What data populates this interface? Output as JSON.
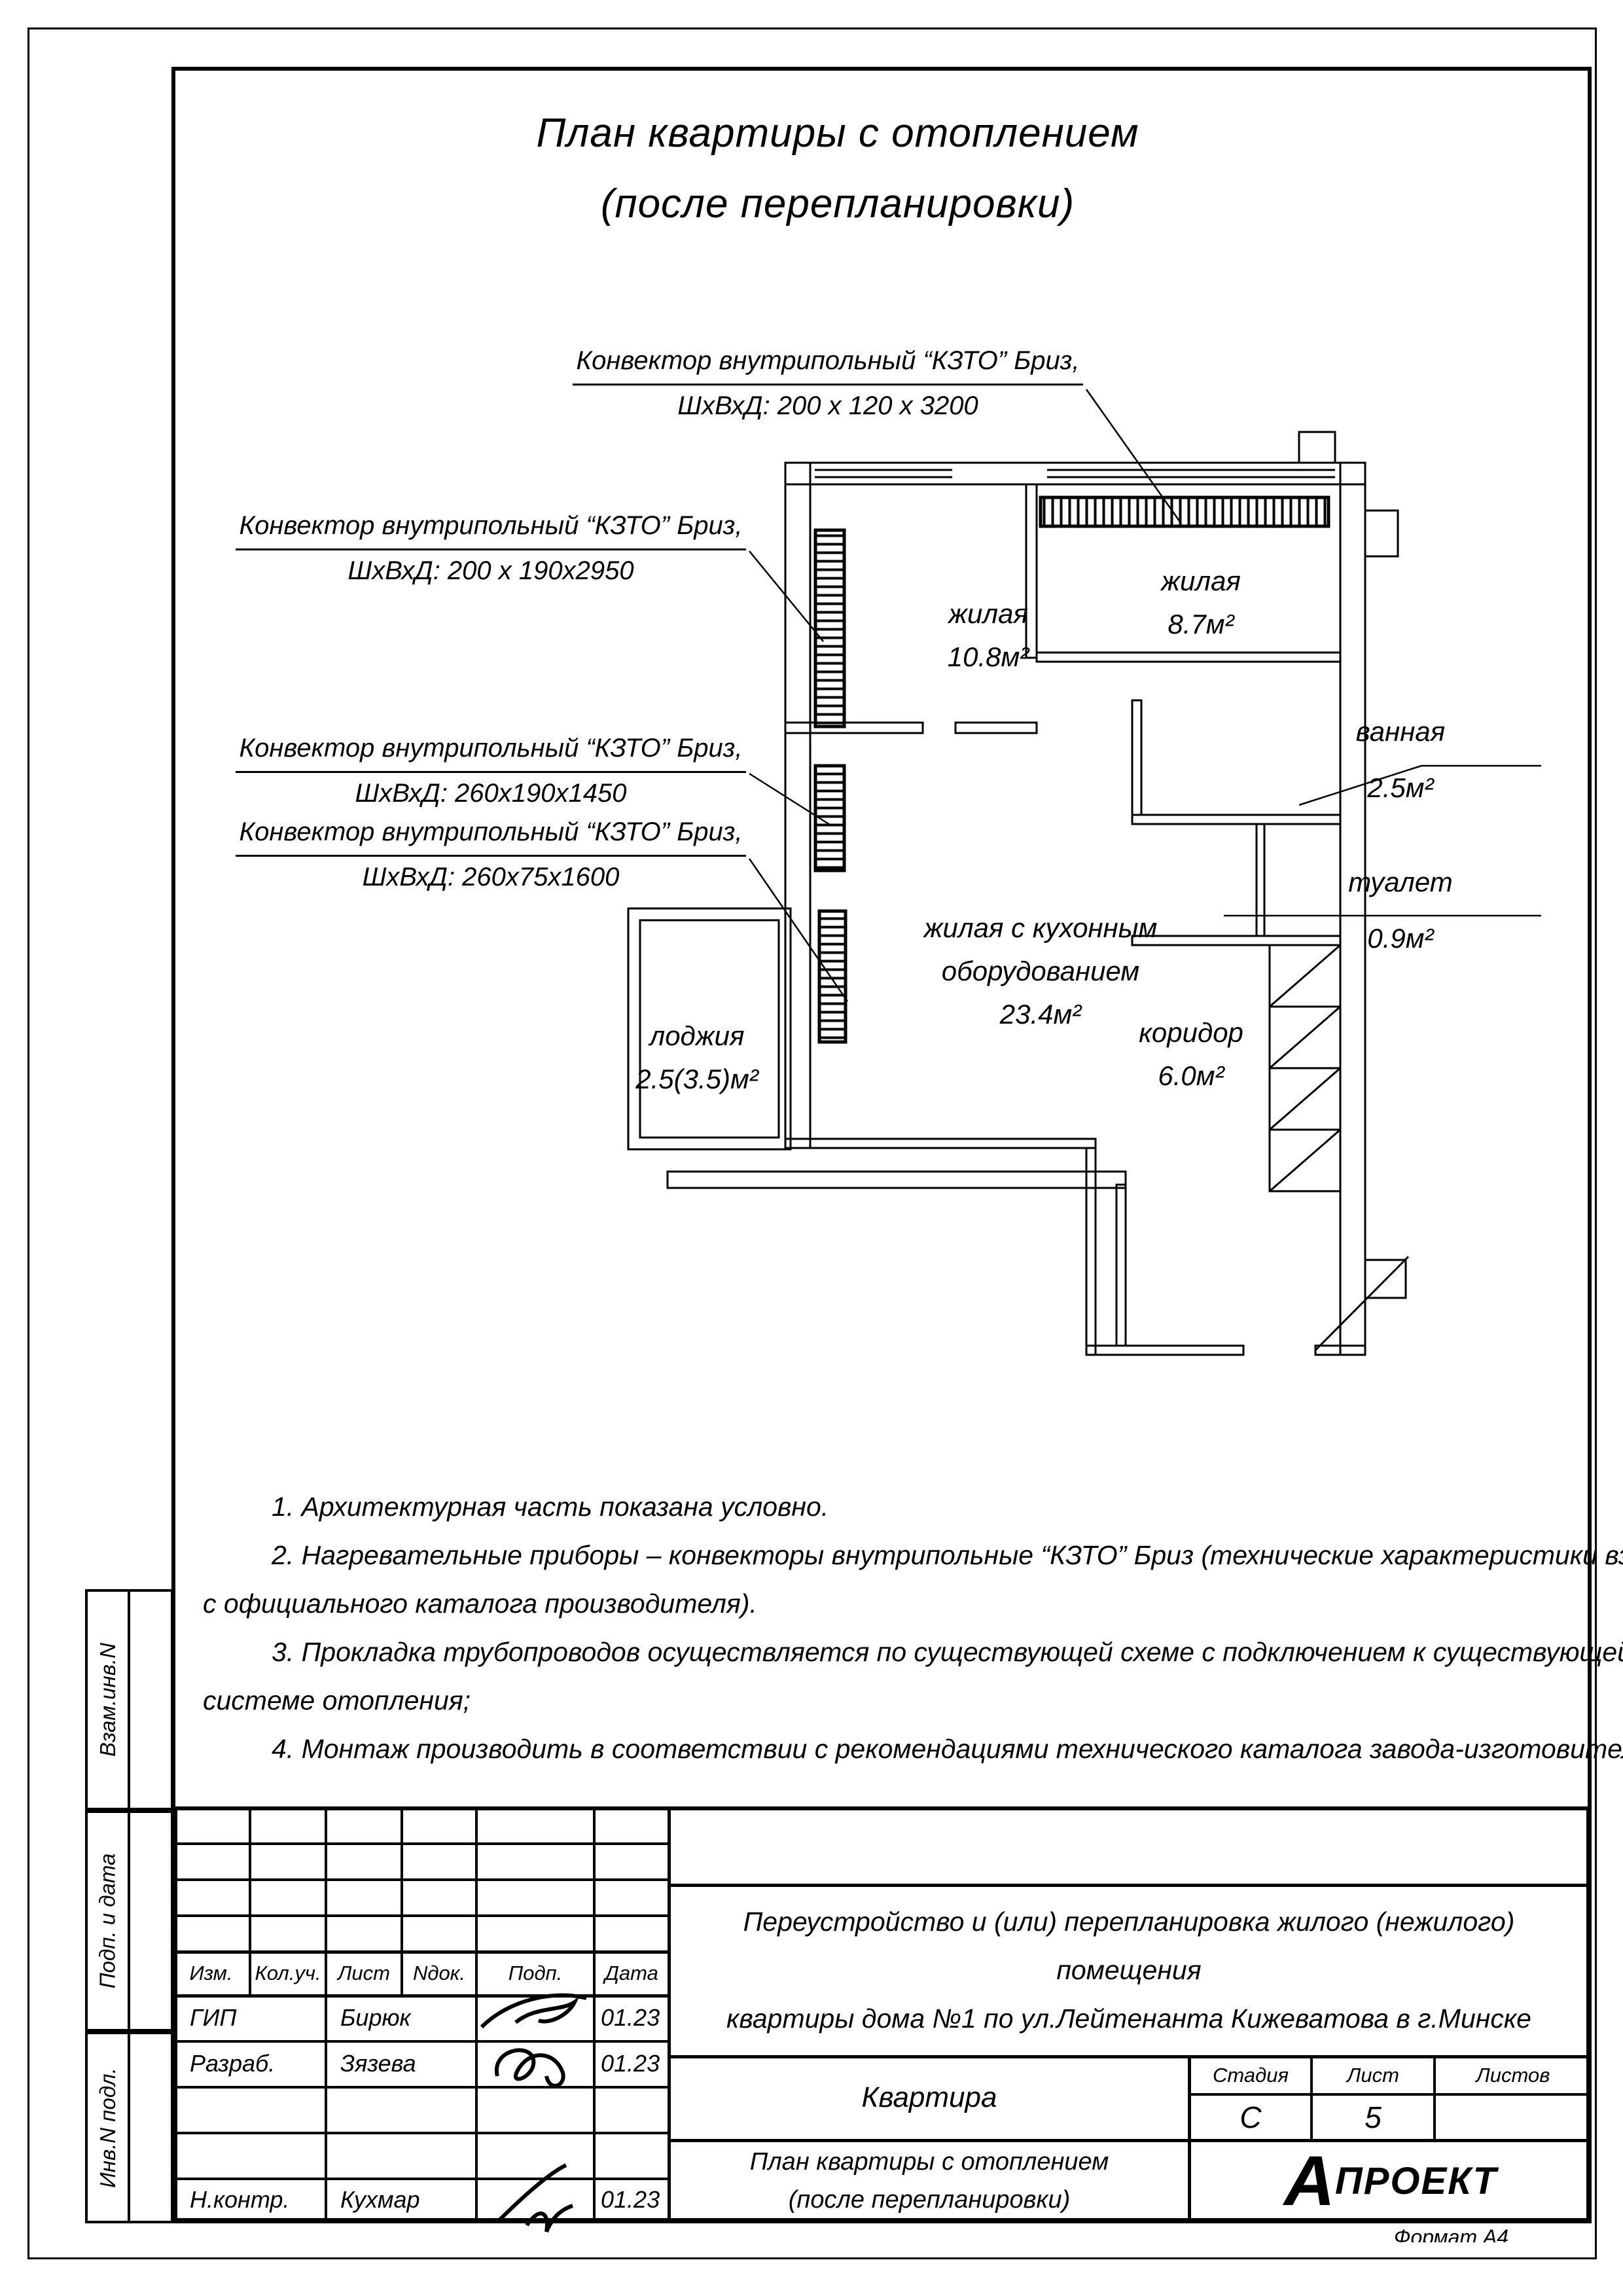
{
  "title": {
    "line1": "План квартиры с отоплением",
    "line2": "(после перепланировки)"
  },
  "callouts": [
    {
      "line1": "Конвектор внутрипольный “КЗТО” Бриз,",
      "line2": "ШхВхД:  200 х 120 х 3200"
    },
    {
      "line1": "Конвектор внутрипольный “КЗТО” Бриз,",
      "line2": "ШхВхД:  200 х 190х2950"
    },
    {
      "line1": "Конвектор внутрипольный “КЗТО” Бриз,",
      "line2": "ШхВхД: 260х190х1450"
    },
    {
      "line1": "Конвектор внутрипольный “КЗТО” Бриз,",
      "line2": "ШхВхД: 260х75х1600"
    }
  ],
  "rooms": [
    {
      "name": "жилая",
      "area": "10.8м²"
    },
    {
      "name": "жилая",
      "area": "8.7м²"
    },
    {
      "name": "жилая с кухонным",
      "name2": "оборудованием",
      "area": "23.4м²"
    },
    {
      "name": "лоджия",
      "area": "2.5(3.5)м²"
    },
    {
      "name": "коридор",
      "area": "6.0м²"
    },
    {
      "name": "ванная",
      "area": "2.5м²"
    },
    {
      "name": "туалет",
      "area": "0.9м²"
    }
  ],
  "notes": [
    "1. Архитектурная часть показана условно.",
    "2. Нагревательные приборы – конвекторы внутрипольные “КЗТО” Бриз (технические характеристики взяты",
    "с официального каталога производителя).",
    "3. Прокладка трубопроводов осуществляется по существующей схеме с подключением к существующей",
    "системе отопления;",
    "4. Монтаж производить в соответствии с рекомендациями технического каталога завода-изготовителя."
  ],
  "sidebar": {
    "box1": "Взам.инв.N",
    "box2": "Подп. и дата",
    "box3": "Инв.N подл."
  },
  "stamp": {
    "rev_headers": [
      "Изм.",
      "Кол.уч.",
      "Лист",
      "Nдок.",
      "Подп.",
      "Дата"
    ],
    "staff": [
      {
        "role": "ГИП",
        "name": "Бирюк",
        "date": "01.23"
      },
      {
        "role": "Разраб.",
        "name": "Зязева",
        "date": "01.23"
      },
      {
        "role": "Н.контр.",
        "name": "Кухмар",
        "date": "01.23"
      }
    ],
    "project": {
      "line1": "Переустройство и (или) перепланировка жилого (нежилого) помещения",
      "line2": "квартиры дома №1 по ул.Лейтенанта Кижеватова в г.Минске"
    },
    "object_name": "Квартира",
    "stage_label": "Стадия",
    "sheet_label": "Лист",
    "sheets_label": "Листов",
    "stage_value": "С",
    "sheet_value": "5",
    "sheets_value": "",
    "sheet_title_line1": "План квартиры с отоплением",
    "sheet_title_line2": "(после перепланировки)",
    "logo_a": "А",
    "logo_text": "ПРОЕКТ"
  },
  "footer": {
    "format_note": "Формат А4"
  }
}
